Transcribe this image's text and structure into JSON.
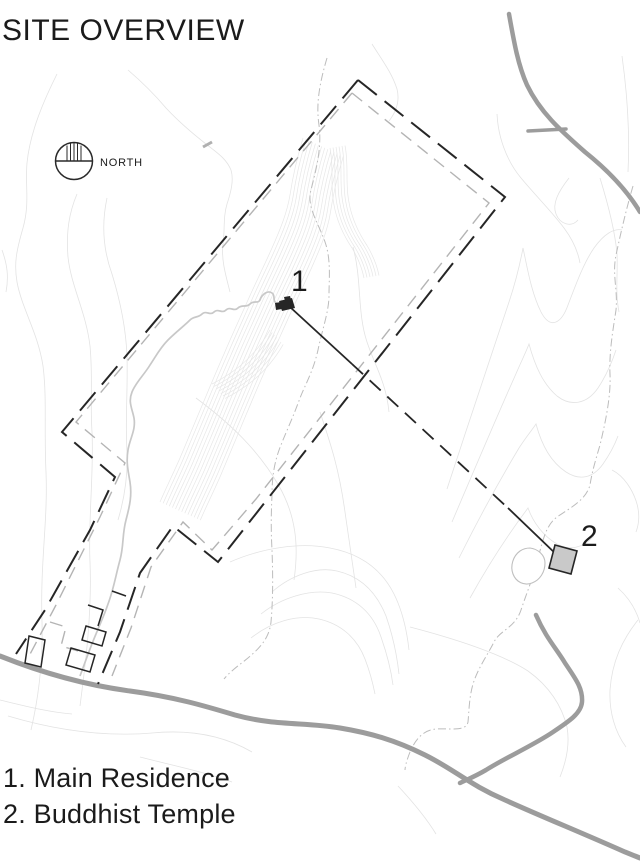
{
  "title": "SITE OVERVIEW",
  "north": {
    "label": "NORTH"
  },
  "markers": {
    "residence": "1",
    "temple": "2"
  },
  "legend": {
    "items": [
      "1. Main Residence",
      "2. Buddhist Temple"
    ]
  },
  "colors": {
    "ink": "#262626",
    "text": "#1b1b1b",
    "road": "#9c9c9c",
    "contour": "#e3e3e3",
    "stream": "#bcbcbc",
    "boundary_inner": "#b4b4b4",
    "driveway": "#c8c8c8",
    "temple_fill": "#c9c9c9",
    "background": "#ffffff"
  }
}
